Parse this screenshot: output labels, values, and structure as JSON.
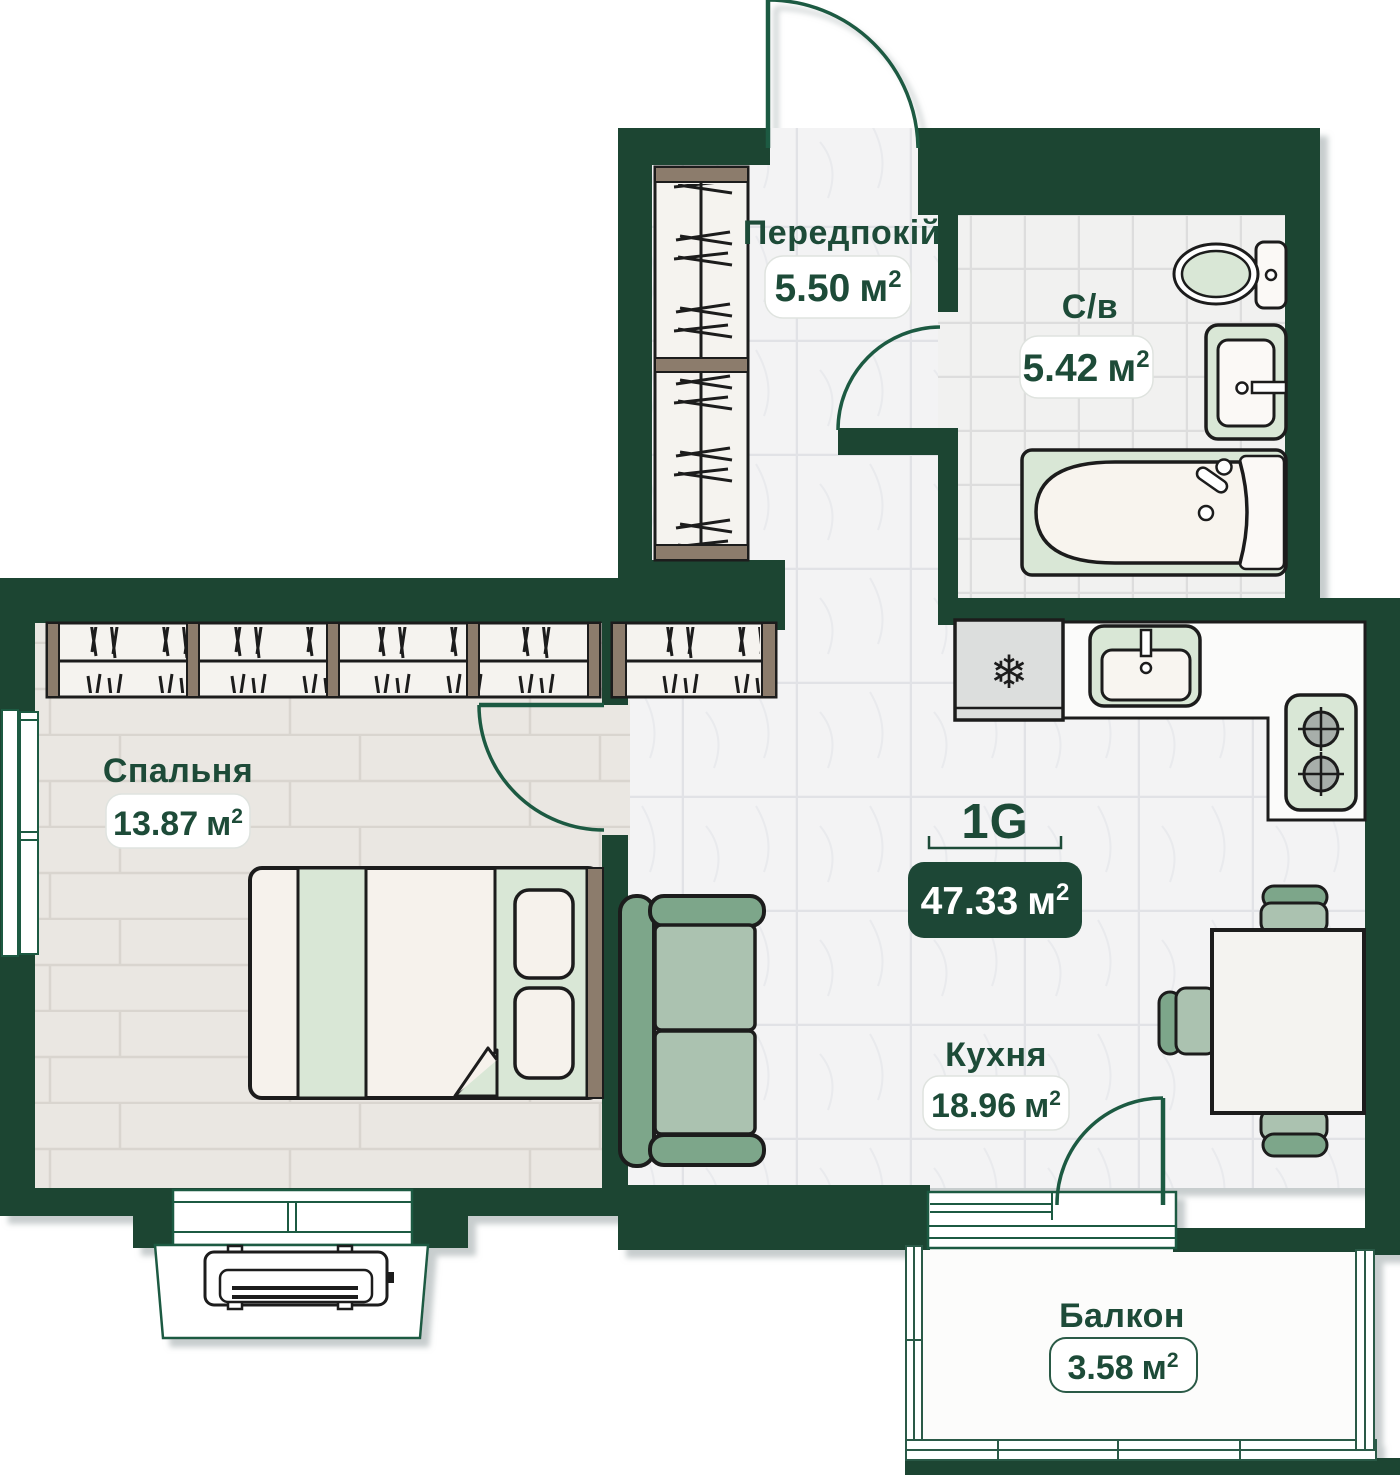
{
  "apartment": {
    "code": "1G",
    "total_area": "47.33"
  },
  "units": {
    "meter": "м",
    "sup": "2"
  },
  "rooms": {
    "hallway": {
      "name": "Передпокій",
      "area": "5.50"
    },
    "bathroom": {
      "name": "С/в",
      "area": "5.42"
    },
    "bedroom": {
      "name": "Спальня",
      "area": "13.87"
    },
    "kitchen": {
      "name": "Кухня",
      "area": "18.96"
    },
    "balcony": {
      "name": "Балкон",
      "area": "3.58"
    }
  },
  "icons": {
    "fridge_snowflake": "❄"
  },
  "colors": {
    "wall": "#1c4433",
    "door_accent": "#1e5a43",
    "label_text": "#1d4b38",
    "badge_dark_bg": "#1d4736",
    "furniture_light_green": "#d9e7d6",
    "furniture_mid_green": "#7da68a",
    "furniture_sage": "#abc2b0",
    "wood_trim": "#8c7c6c"
  }
}
